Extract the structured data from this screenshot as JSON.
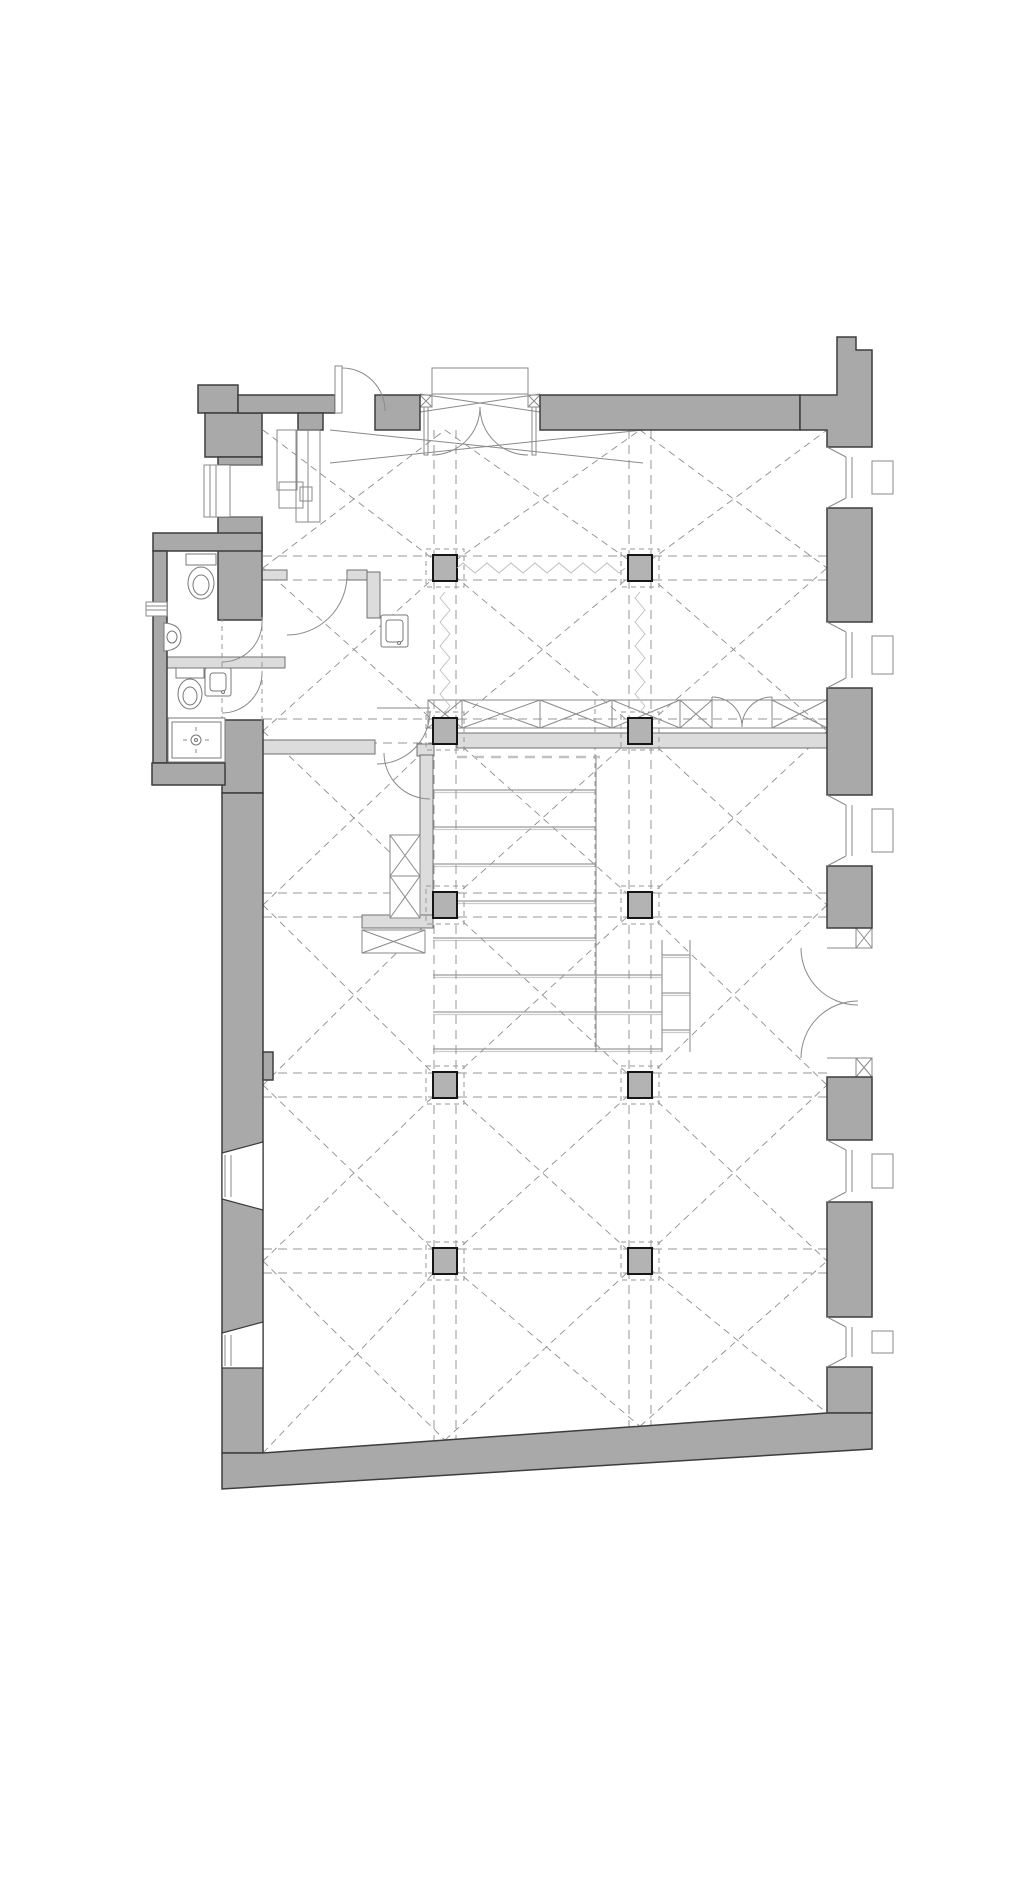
{
  "document": {
    "type": "architectural-floor-plan",
    "description": "ground floor plan of a vaulted hall building with sanitary annex, column grid and tribune stair",
    "page_width_px": 1026,
    "page_height_px": 1878,
    "visible_text": []
  },
  "palette": {
    "background": "#ffffff",
    "wall_fill": "#a9a9a9",
    "wall_outline": "#3d3d3d",
    "partition_fill": "#dcdcdc",
    "partition_outline": "#707070",
    "column_fill": "#b3b3b3",
    "column_outline": "#161616",
    "grid_dash": "#979797",
    "vault_dash": "#8f8f8f",
    "detail_line": "#8a8a8a",
    "fixture_line": "#787878",
    "tread_line": "#9a9a9a"
  },
  "structure": {
    "column_grid": {
      "x_centers": [
        445,
        640
      ],
      "y_centers": [
        568,
        731,
        905,
        1085,
        1261
      ],
      "count": 10,
      "size": [
        24,
        26
      ],
      "dashed_frame_size": 38
    },
    "bays": {
      "x_bounds": [
        263,
        445,
        640,
        827
      ],
      "y_bounds": [
        430,
        568,
        731,
        905,
        1085,
        1261
      ],
      "bottom_edge": {
        "x_from": 263,
        "y_from": 1453,
        "x_to": 827,
        "y_to": 1413
      }
    },
    "beam_wave_lines": [
      {
        "from": [
          457,
          568
        ],
        "to": [
          629,
          568
        ]
      },
      {
        "from": [
          445,
          592
        ],
        "to": [
          445,
          714
        ]
      },
      {
        "from": [
          640,
          592
        ],
        "to": [
          640,
          714
        ]
      }
    ],
    "tribune_steps": {
      "tread_lines": [
        [
          790,
          433,
          596
        ],
        [
          827,
          433,
          596
        ],
        [
          864,
          433,
          596
        ],
        [
          901,
          433,
          596
        ],
        [
          938,
          433,
          596
        ],
        [
          975,
          433,
          662
        ],
        [
          1012,
          433,
          662
        ],
        [
          1049,
          433,
          662
        ]
      ],
      "side_tread_lines": [
        [
          955,
          662,
          690
        ],
        [
          993,
          662,
          690
        ],
        [
          1030,
          662,
          690
        ]
      ]
    }
  },
  "openings": {
    "windows": [
      {
        "name": "window-left-upper",
        "wall": "left",
        "y_span": [
          465,
          517
        ]
      },
      {
        "name": "window-right-1",
        "wall": "right",
        "y_span": [
          447,
          508
        ]
      },
      {
        "name": "window-right-2",
        "wall": "right",
        "y_span": [
          622,
          688
        ]
      },
      {
        "name": "window-right-3",
        "wall": "right",
        "y_span": [
          795,
          866
        ]
      },
      {
        "name": "window-right-4",
        "wall": "right",
        "y_span": [
          1140,
          1202
        ]
      },
      {
        "name": "window-right-5",
        "wall": "right",
        "y_span": [
          1317,
          1367
        ]
      },
      {
        "name": "window-left-lower-1",
        "wall": "left",
        "y_span": [
          1142,
          1210
        ]
      },
      {
        "name": "window-left-lower-2",
        "wall": "left",
        "y_span": [
          1322,
          1368
        ]
      },
      {
        "name": "annex-vent",
        "wall": "annex-left",
        "y_span": [
          602,
          616
        ]
      }
    ],
    "doors": [
      {
        "name": "top-single-door",
        "wall": "top",
        "x_span": [
          335,
          375
        ],
        "swing": "out"
      },
      {
        "name": "main-entrance-double-door",
        "wall": "top",
        "x_span": [
          432,
          528
        ],
        "swing": "in",
        "posts": 2
      },
      {
        "name": "side-double-door",
        "wall": "right",
        "y_span": [
          948,
          1058
        ],
        "swing": "in",
        "posts": 2
      },
      {
        "name": "mezzanine-railing-double-door",
        "x_span": [
          712,
          772
        ],
        "swing": "north"
      },
      {
        "name": "wc-door-1",
        "wall": "left-corridor",
        "y_span": [
          622,
          662
        ]
      },
      {
        "name": "wc-door-2",
        "wall": "left-corridor",
        "y_span": [
          673,
          713
        ]
      },
      {
        "name": "lobby-room-door",
        "x_span": [
          287,
          347
        ]
      },
      {
        "name": "stair-door-upper",
        "near": [
          430,
          711
        ]
      },
      {
        "name": "stair-door-lower",
        "near": [
          384,
          753
        ]
      }
    ]
  },
  "rooms": [
    {
      "name": "main-vaulted-hall"
    },
    {
      "name": "upper-left-office"
    },
    {
      "name": "lobby-with-basin"
    },
    {
      "name": "wc-room-upper",
      "fixtures": [
        "toilet",
        "urinal"
      ]
    },
    {
      "name": "wc-room-lower",
      "fixtures": [
        "toilet",
        "washbasin"
      ]
    },
    {
      "name": "shower-room",
      "fixtures": [
        "shower-tray"
      ]
    },
    {
      "name": "tribune-stair-hall"
    }
  ],
  "fixtures": [
    {
      "name": "toilet-upper",
      "at": [
        201,
        583
      ]
    },
    {
      "name": "urinal",
      "at": [
        172,
        637
      ]
    },
    {
      "name": "toilet-lower",
      "at": [
        190,
        694
      ]
    },
    {
      "name": "washbasin-wc",
      "at": [
        218,
        682
      ]
    },
    {
      "name": "shower-tray",
      "at": [
        196,
        740
      ]
    },
    {
      "name": "washbasin-lobby",
      "at": [
        394,
        631
      ]
    },
    {
      "name": "desk-and-cabinets",
      "at": [
        295,
        475
      ]
    }
  ]
}
